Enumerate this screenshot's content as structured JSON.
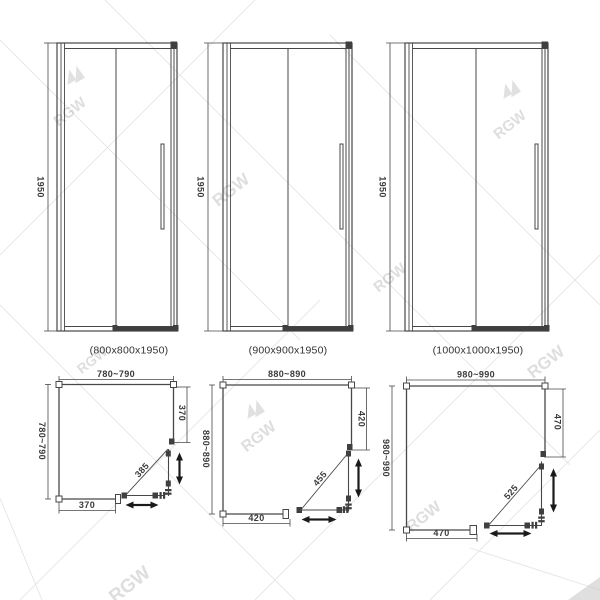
{
  "watermark": {
    "brand": "RGW"
  },
  "elevations": [
    {
      "height": "1950",
      "label": "(800x800x1950)"
    },
    {
      "height": "1950",
      "label": "(900x900x1950)"
    },
    {
      "height": "1950",
      "label": "(1000x1000x1950)"
    }
  ],
  "plans": [
    {
      "top": "780~790",
      "left": "780~790",
      "right": "370",
      "bottom": "370",
      "diagonal": "385"
    },
    {
      "top": "880~890",
      "left": "880~890",
      "right": "420",
      "bottom": "420",
      "diagonal": "455"
    },
    {
      "top": "980~990",
      "left": "980~990",
      "right": "470",
      "bottom": "470",
      "diagonal": "525"
    }
  ]
}
